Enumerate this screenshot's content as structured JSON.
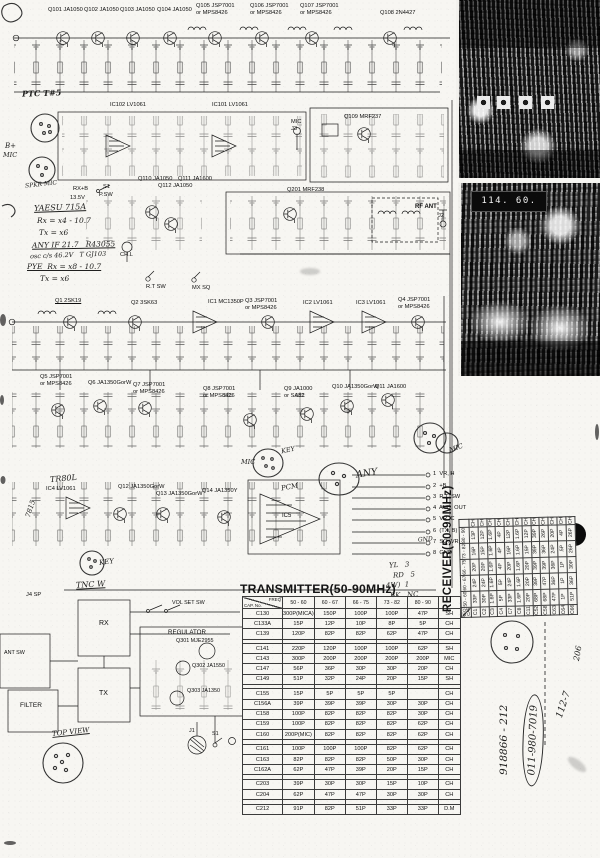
{
  "titles": {
    "transmitter": "TRANSMITTER(50-90MHz)",
    "receiver": "RECEIVER(50-90MHz)"
  },
  "photo": {
    "freq_display": "114. 60."
  },
  "schematic": {
    "top_row": [
      "Q101 JA1050",
      "Q102 JA1050",
      "Q103 JA1050",
      "Q104 JA1050",
      "Q105 JSP7001\nor MPS8426",
      "Q106 JSP7001\nor MPS8426",
      "Q107 JSP7001\nor MPS8426",
      "Q108 2N4427"
    ],
    "ic_row": [
      "IC102 LV1061",
      "IC101 LV1061",
      "MIC\nJ3",
      "Q109 MRF237"
    ],
    "pa_row": [
      "Q110 JA1050",
      "Q111 JA1600",
      "Q112 JA1050",
      "Q201 MRF238",
      "RF ANT",
      "J2"
    ],
    "rx_row": [
      "Q1 2SK19",
      "Q2 3SK63",
      "IC1 MC1350P",
      "Q3 JSP7001\nor MPS8426",
      "IC2 LV1061",
      "IC3 LV1061",
      "Q4 JSP7001\nor MPS8426"
    ],
    "mid_row": [
      "Q5 JSP7001\nor MPS8426",
      "Q6 JA1350GorW",
      "Q7 JSP7001\nor MPS8426",
      "Q8 JSP7001\nor MPS8426",
      "Q9 JA1000\nor SA82",
      "Q10 JA1350GorW",
      "Q11 JA1600"
    ],
    "low_row": [
      "IC4 LV1061",
      "Q12 JA1350GorW",
      "Q13 JA1350GorW",
      "Q14 JA1350Y",
      "IC5"
    ],
    "pins": [
      "1  VR, H",
      "2  +B",
      "3  R.T. SW",
      "4  AUD. OUT",
      "5  VR. C",
      "6  (TX, B)",
      "7  SQ. VR. C",
      "8  GND"
    ],
    "controls": {
      "rx_b": "RX+B",
      "supply": "13.5V",
      "s1": "S1",
      "psw": "P.SW",
      "rt_sw": "R.T SW",
      "mx_sq": "MX SQ",
      "chl": "CH.L"
    }
  },
  "bottom_left": {
    "j4": "J4 SP",
    "rx": "RX",
    "tx": "TX",
    "regulator": "REGULATOR",
    "q301": "Q301 MJE2955",
    "q302": "Q302 JA1550",
    "q303": "Q303 JA1350",
    "vol": "VOL SET SW",
    "filter": "FILTER",
    "ant_sw": "ANT SW",
    "j1": "J1",
    "s1": "S1"
  },
  "handwriting": {
    "ptc": "PTC T#5",
    "bplus": "B+",
    "mic_left": "MIC",
    "spkr": "SPKR MIC",
    "yaesu": "YAESU 715A",
    "rx_eq": "Rx = x4 - 10.7",
    "tx_eq": "Tx = x6",
    "any_if": "ANY IF 21.7   R43055",
    "osc": "osc c/s 46.2V   T GJ103",
    "pye": "PYE  Rx = x8 - 10.7",
    "tx_eq2": "Tx = x6",
    "tr80l": "TR80L",
    "v7815": "7815",
    "key1": "KEY",
    "key2": "KEY",
    "tnc": "TNC W",
    "mic_conn": "MIC",
    "pcm": "PCM",
    "any": "ANY",
    "mic_r": "MIC",
    "gnd": "GND",
    "yl": "YL   3",
    "rd": "RD   5",
    "fw": "4W)  1",
    "bk": "BK   NC",
    "top_view": "TOP VIEW",
    "serial": "918866 - 212",
    "phone": "011-980-7019",
    "code": "112-7",
    "num": "206"
  },
  "transmitter_table": {
    "corner": {
      "top": "FREQ",
      "bottom": "CAP. No."
    },
    "headers": [
      "50 - 60",
      "60 - 67",
      "66 - 75",
      "73 - 82",
      "80 - 90"
    ],
    "rows": [
      {
        "cap": "C130",
        "values": [
          "300P(MICA)",
          "150P",
          "100P",
          "100P",
          "47P"
        ],
        "type": "SH"
      },
      {
        "cap": "C133A",
        "values": [
          "15P",
          "12P",
          "10P",
          "8P",
          "5P"
        ],
        "type": "CH"
      },
      {
        "cap": "C139",
        "values": [
          "120P",
          "82P",
          "82P",
          "62P",
          "47P"
        ],
        "type": "CH"
      },
      {
        "sep": true
      },
      {
        "cap": "C141",
        "values": [
          "220P",
          "120P",
          "100P",
          "100P",
          "62P"
        ],
        "type": "SH"
      },
      {
        "cap": "C143",
        "values": [
          "300P",
          "200P",
          "200P",
          "200P",
          "200P"
        ],
        "type": "MIC"
      },
      {
        "cap": "C147",
        "values": [
          "56P",
          "36P",
          "30P",
          "30P",
          "20P"
        ],
        "type": "CH"
      },
      {
        "cap": "C149",
        "values": [
          "51P",
          "32P",
          "24P",
          "20P",
          "15P"
        ],
        "type": "SH"
      },
      {
        "sep": true
      },
      {
        "cap": "C155",
        "values": [
          "15P",
          "5P",
          "5P",
          "5P",
          ""
        ],
        "type": "CH"
      },
      {
        "cap": "C156A",
        "values": [
          "39P",
          "39P",
          "39P",
          "30P",
          "30P"
        ],
        "type": "CH"
      },
      {
        "cap": "C158",
        "values": [
          "100P",
          "82P",
          "82P",
          "82P",
          "30P"
        ],
        "type": "CH"
      },
      {
        "cap": "C159",
        "values": [
          "100P",
          "82P",
          "82P",
          "82P",
          "62P"
        ],
        "type": "CH"
      },
      {
        "cap": "C160",
        "values": [
          "200P(MIC)",
          "82P",
          "82P",
          "82P",
          "62P"
        ],
        "type": "CH"
      },
      {
        "sep": true
      },
      {
        "cap": "C161",
        "values": [
          "100P",
          "100P",
          "100P",
          "82P",
          "62P"
        ],
        "type": "CH"
      },
      {
        "cap": "C163",
        "values": [
          "82P",
          "82P",
          "82P",
          "50P",
          "30P"
        ],
        "type": "CH"
      },
      {
        "cap": "C162A",
        "values": [
          "62P",
          "47P",
          "39P",
          "20P",
          "15P"
        ],
        "type": "CH"
      },
      {
        "sep": true
      },
      {
        "cap": "C203",
        "values": [
          "39P",
          "30P",
          "30P",
          "15P",
          "10P"
        ],
        "type": "CH"
      },
      {
        "cap": "C204",
        "values": [
          "62P",
          "47P",
          "47P",
          "30P",
          "30P"
        ],
        "type": "CH"
      },
      {
        "sep": true
      },
      {
        "cap": "C212",
        "values": [
          "91P",
          "82P",
          "51P",
          "33P",
          "33P"
        ],
        "type": "D.M"
      }
    ]
  },
  "receiver_table": {
    "corner": {
      "top": "FREQ",
      "bottom": "CAP. No."
    },
    "headers": [
      "50 - 60",
      "60 - 67",
      "66 - 75",
      "73 - 82",
      "80 - 90"
    ],
    "rows": [
      {
        "cap": "C1",
        "values": [
          "33P",
          "24P",
          "20P",
          "16P",
          "13P"
        ],
        "type": "CH"
      },
      {
        "cap": "C2",
        "values": [
          "30P",
          "24P",
          "20P",
          "15P",
          "12P"
        ],
        "type": "CH"
      },
      {
        "cap": "C3",
        "values": [
          "1.6P",
          "1.6P",
          "1.6P",
          "1.6P",
          "1.6P"
        ],
        "type": "CH"
      },
      {
        "cap": "C4",
        "values": [
          "5P",
          "5P",
          "4P",
          "4P",
          "4P"
        ],
        "type": "CH"
      },
      {
        "cap": "C7",
        "values": [
          "33P",
          "24P",
          "20P",
          "16P",
          "12P"
        ],
        "type": "CH"
      },
      {
        "cap": "C8",
        "values": [
          "1.6P",
          "1.6P",
          "1.6P",
          "1.6P",
          "1.6P"
        ],
        "type": "CH"
      },
      {
        "cap": "C11",
        "values": [
          "20P",
          "20P",
          "20P",
          "15P",
          "12P"
        ],
        "type": "CH"
      },
      {
        "cap": "C52",
        "values": [
          "68P",
          "39P",
          "39P",
          "39P",
          "39P"
        ],
        "type": "CH"
      },
      {
        "cap": "C58",
        "values": [
          "68P",
          "47P",
          "39P",
          "36P",
          "26P"
        ],
        "type": "CH"
      },
      {
        "cap": "C63",
        "values": [
          "47P",
          "36P",
          "36P",
          "24P",
          "20P"
        ],
        "type": "CH"
      },
      {
        "cap": "C64",
        "values": [
          "1P",
          "1P",
          "1P",
          ".5P",
          "4P"
        ],
        "type": "CH"
      },
      {
        "cap": "C66",
        "values": [
          "51P",
          "36P",
          "30P",
          "26P",
          "26P"
        ],
        "type": "CH"
      }
    ]
  }
}
